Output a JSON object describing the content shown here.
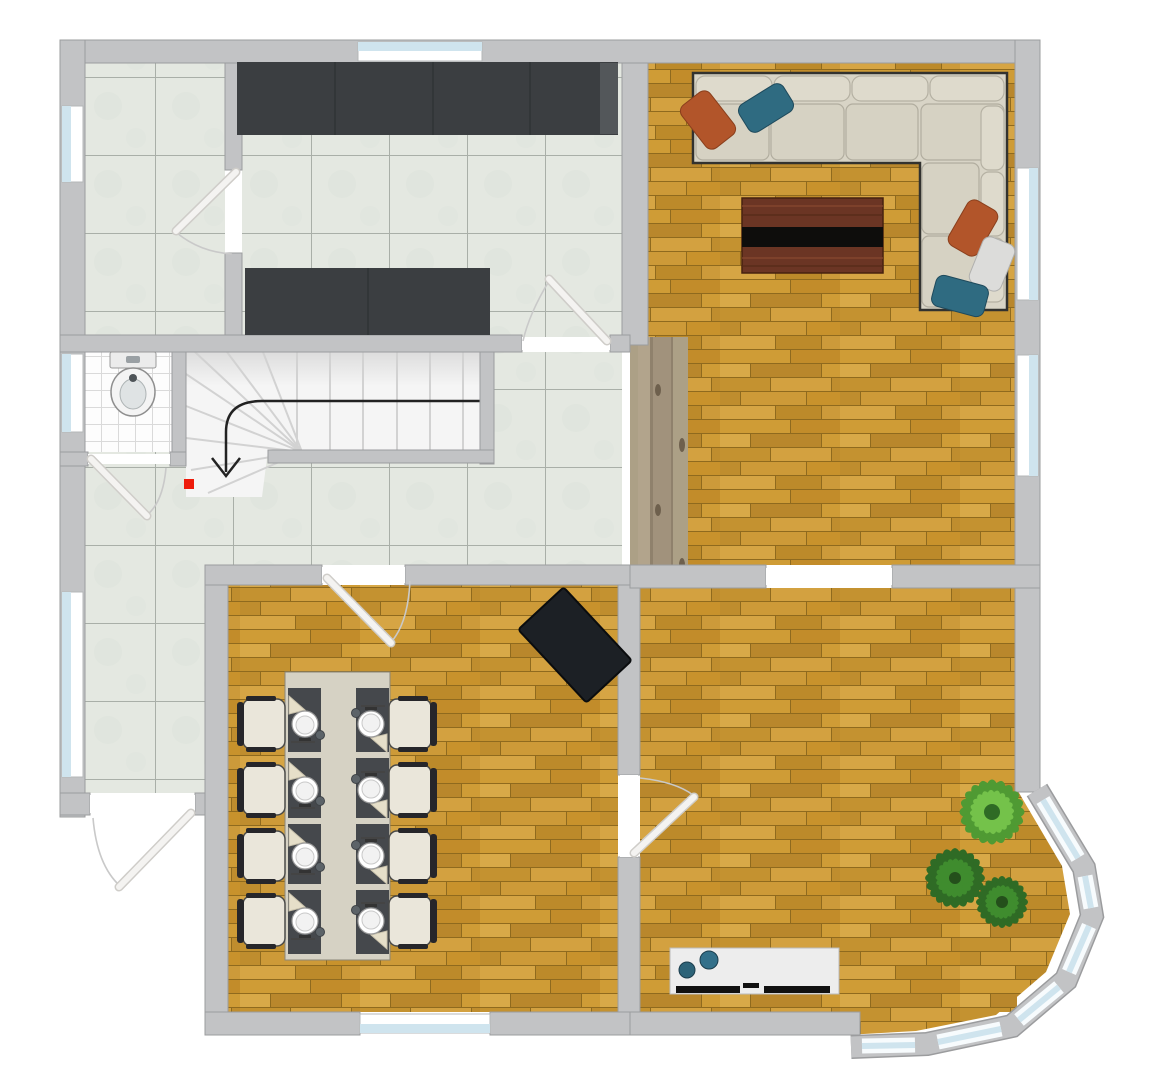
{
  "scene": {
    "type": "floor-plan",
    "view": "top-down",
    "canvas": {
      "width": 1154,
      "height": 1080
    },
    "background": "#ffffff"
  },
  "colors": {
    "wall": "#c2c3c5",
    "wall_edge": "#9b9c9e",
    "threshold": "#ffffff",
    "window_frame": "#ffffff",
    "glass": "#cfe4ee",
    "tile_floor": "#e4e8e1",
    "tile_line": "#a9afa8",
    "bath_tile": "#fdfdfd",
    "parquet_light": "#d6a544",
    "parquet_dark": "#b9872c",
    "passage_plank": "#a7997f",
    "counter": "#3b3e41",
    "sofa": "#d8d4c6",
    "pillow_orange": "#b2552a",
    "pillow_teal": "#2f6b81",
    "pillow_white": "#dcdcda",
    "coffee_table_wood": "#6b3524",
    "coffee_table_stripe": "#0e0d0c",
    "dining_mat": "#45484c",
    "table_runner": "#d6d2c4",
    "chair": "#eae6da",
    "plant_dark": "#2f6b25",
    "plant_mid": "#3f8c2e",
    "plant_light": "#74c24a",
    "stair_tread": "#f5f5f5",
    "arrow": "#222222",
    "stair_marker_red": "#ee1b0b",
    "sideboard": "#ededed",
    "decor_ball_teal": "#2d6378",
    "dark_rug_stove": "#1c2025"
  },
  "rooms": [
    {
      "id": "pantry",
      "floor": "large-tile",
      "windows": 1,
      "doors": 1
    },
    {
      "id": "kitchen",
      "floor": "large-tile",
      "furniture": [
        "counter-top-run",
        "counter-island-run"
      ],
      "windows": 1,
      "doors": 1
    },
    {
      "id": "bathroom",
      "floor": "small-white-tile",
      "furniture": [
        "bidet"
      ],
      "windows": 1,
      "doors": 1
    },
    {
      "id": "hallway",
      "floor": "large-tile",
      "features": [
        "staircase",
        "entry-door"
      ],
      "windows": 1
    },
    {
      "id": "living-room",
      "floor": "oak-parquet",
      "furniture": [
        "corner-sofa",
        "coffee-table"
      ],
      "sofa_pillows": 5,
      "windows": 2,
      "passages": 2
    },
    {
      "id": "dining-room",
      "floor": "oak-parquet",
      "furniture": [
        "dining-table",
        "chairs",
        "dark-rotated-rug"
      ],
      "chairs": 8,
      "place_settings": 8,
      "windows": 1,
      "doors": 2
    },
    {
      "id": "family-room",
      "floor": "oak-parquet",
      "furniture": [
        "sideboard",
        "plants"
      ],
      "decor_balls": 2,
      "plants": 3,
      "bay_window_panes": 6
    }
  ],
  "staircase": {
    "type": "winder",
    "direction_arrow": "down",
    "straight_treads": 6,
    "marker_color": "#ee1b0b"
  },
  "openings": {
    "windows_total": 13,
    "doors_total": 6,
    "open_passages": 2
  }
}
